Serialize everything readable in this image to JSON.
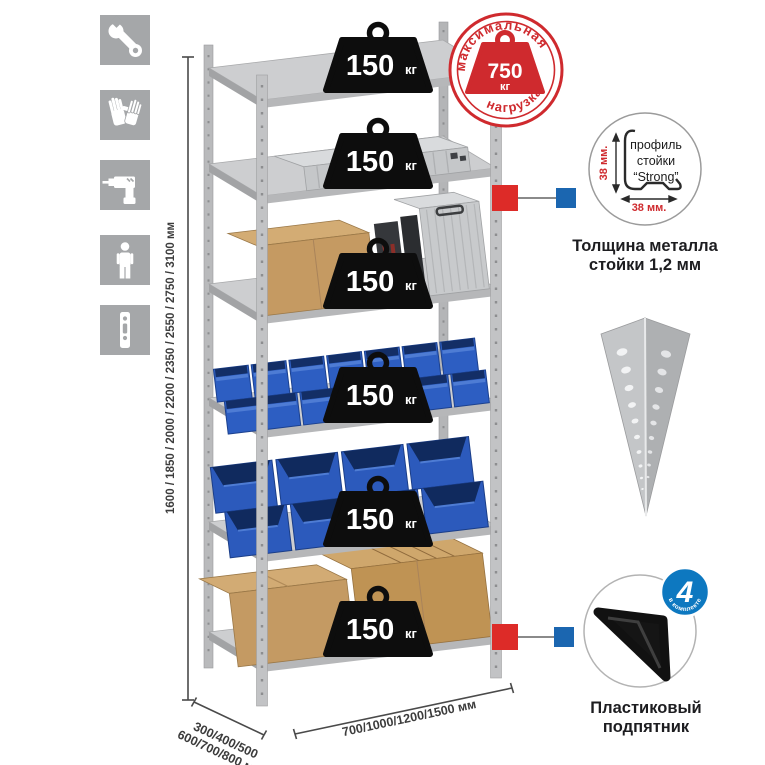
{
  "icons": {
    "items": [
      "wrench",
      "gloves",
      "drill",
      "person",
      "post-profile"
    ]
  },
  "dims": {
    "height": "1600 / 1850 / 2000 / 2200 / 2350 / 2550 / 2750 / 3100 мм",
    "depth1": "300/400/500",
    "depth2": "600/700/800 мм",
    "width": "700/1000/1200/1500 мм"
  },
  "stamp": {
    "arc_top": "максимальная",
    "arc_bottom": "нагрузка",
    "value": "750",
    "unit": "кг"
  },
  "shelves": [
    {
      "load": "150",
      "unit": "кг"
    },
    {
      "load": "150",
      "unit": "кг"
    },
    {
      "load": "150",
      "unit": "кг"
    },
    {
      "load": "150",
      "unit": "кг"
    },
    {
      "load": "150",
      "unit": "кг"
    },
    {
      "load": "150",
      "unit": "кг"
    }
  ],
  "profile": {
    "l1": "профиль",
    "l2": "стойки",
    "l3": "“Strong”",
    "dim_v": "38 мм.",
    "dim_h": "38 мм.",
    "cap1": "Толщина металла",
    "cap2": "стойки 1,2 мм"
  },
  "foot": {
    "badge_value": "4",
    "badge_arc": "в комплекте",
    "cap1": "Пластиковый",
    "cap2": "подпятник"
  },
  "colors": {
    "accent_red": "#cf2a2e",
    "marker_red": "#dd2b28",
    "marker_blue": "#1b66b0",
    "bin_blue": "#2d5ec2",
    "badge_blue": "#0d78c0",
    "metal_gray": "#c6c8ca",
    "cardboard": "#c49a63"
  }
}
